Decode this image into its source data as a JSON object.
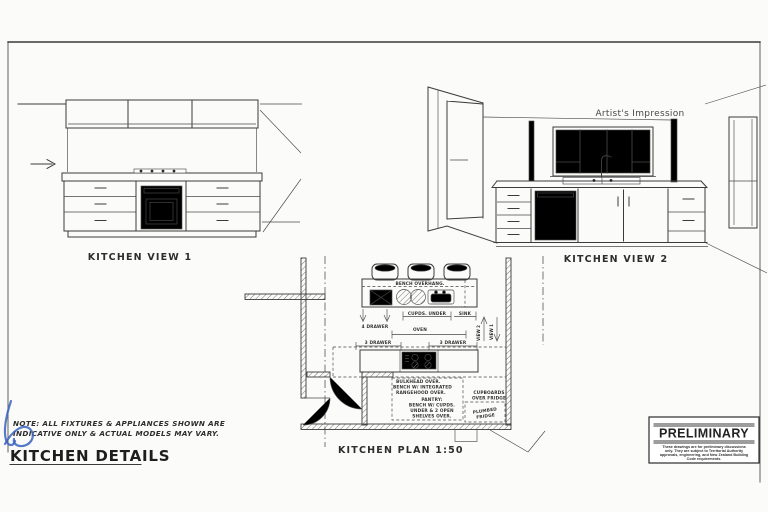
{
  "sheet": {
    "note_line1": "NOTE: ALL FIXTURES & APPLIANCES SHOWN ARE",
    "note_line2": "INDICATIVE ONLY & ACTUAL MODELS MAY VARY.",
    "title": "KITCHEN DETAILS"
  },
  "view1": {
    "label": "KITCHEN VIEW 1"
  },
  "view2": {
    "label": "KITCHEN VIEW 2",
    "caption": "Artist's Impression"
  },
  "plan": {
    "label": "KITCHEN PLAN  1:50",
    "island": {
      "bench_overhang": "BENCH OVERHANG.",
      "four_drawer": "4 DRAWER",
      "cupds_under": "CUPDS. UNDER",
      "sink": "SINK"
    },
    "bench": {
      "oven": "OVEN",
      "three_drawer_left": "3 DRAWER",
      "three_drawer_right": "3 DRAWER"
    },
    "view_arrows": {
      "view1": "VIEW 1",
      "view2": "VIEW 2"
    },
    "notes": {
      "bulkhead": "BULKHEAD OVER.",
      "rangehood1": "BENCH W/ INTEGRATED",
      "rangehood2": "RANGEHOOD OVER.",
      "pantry1": "PANTRY:",
      "pantry2": "BENCH W/ CUPDS.",
      "pantry3": "UNDER & 2 OPEN",
      "pantry4": "SHELVES OVER.",
      "fridge1": "CUPBOARDS",
      "fridge2": "OVER FRIDGE",
      "plumbed1": "PLUMBED",
      "plumbed2": "FRIDGE"
    }
  },
  "stamp": {
    "title": "PRELIMINARY",
    "body_lines": [
      "These drawings are for preliminary discussions",
      "only. They are subject to Territorial Authority",
      "approvals, engineering, and New Zealand Building",
      "Code requirements."
    ]
  },
  "colors": {
    "ink": "#3b3b3b",
    "pen_mark": "#3a63c0"
  }
}
